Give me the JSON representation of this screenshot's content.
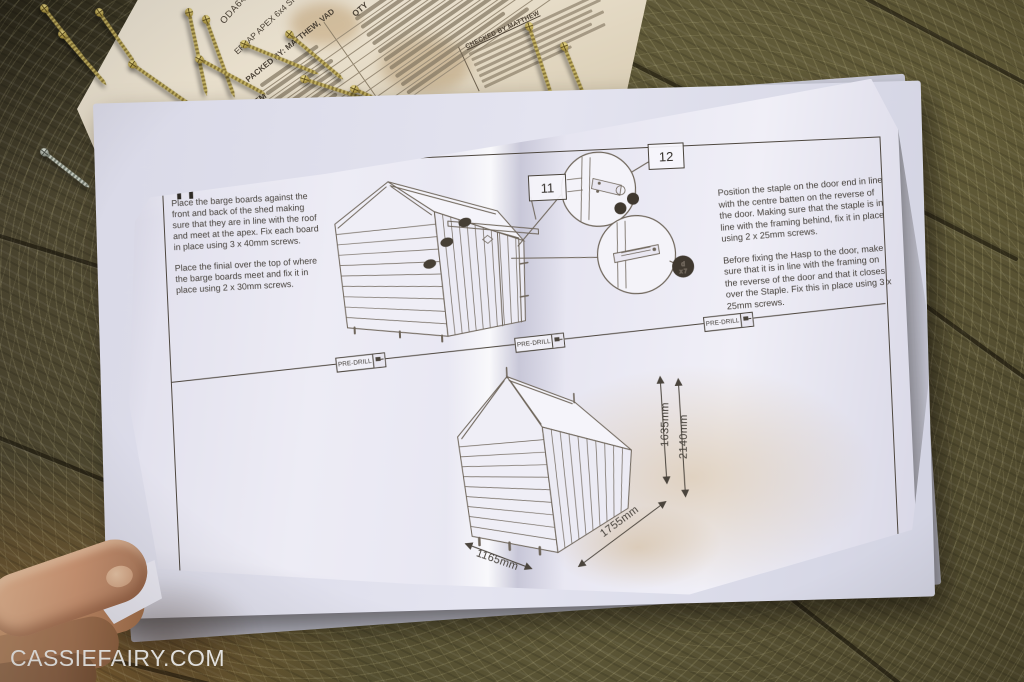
{
  "scene": {
    "watermark": "CASSIEFAIRY.COM"
  },
  "colors": {
    "paper": "#eceaf4",
    "checklist_paper": "#e7ddc9",
    "ink": "#4a443c",
    "wood": "#574f36",
    "gold_screw": "#b3a050",
    "stain": "#c79a4e"
  },
  "checklist": {
    "title_fragment": "NG CHECK",
    "code": "ODA6402NF",
    "product_fragment": "ERLAP APEX 6x4 SH",
    "packed_by_fragment": "PACKED BY: MATTHEW, VAD",
    "column_item": "ITEM",
    "column_qty": "QTY",
    "checked_by_fragment": "CHECKED BY MATTHEW"
  },
  "sheet": {
    "step_label": "H",
    "left_instructions": [
      "Place the barge boards against the front and back of the shed making sure that they are in line with the roof and meet at the apex. Fix each board in place using 3 x 40mm screws.",
      "Place the finial over the top of where the barge boards meet and fix it in place using 2 x 30mm screws."
    ],
    "right_instructions": [
      "Position the staple on the door end in line with the centre batten on the reverse of the door. Making sure that the staple is in line with the framing behind, fix it in place using 2 x 25mm screws.",
      "Before fixing the Hasp to the door, make sure that it is in line with the framing on the reverse of the door and that it closes over the Staple. Fix this in place using 3 x 25mm screws."
    ],
    "callout_11": "11",
    "callout_12": "12",
    "predrill_label": "PRE-DRILL",
    "staple_badge": {
      "line1": "d",
      "line2": "x 7"
    },
    "dimensions": {
      "front_width": "1165mm",
      "side_depth": "1755mm",
      "eaves_height": "1635mm",
      "ridge_height": "2140mm"
    }
  }
}
